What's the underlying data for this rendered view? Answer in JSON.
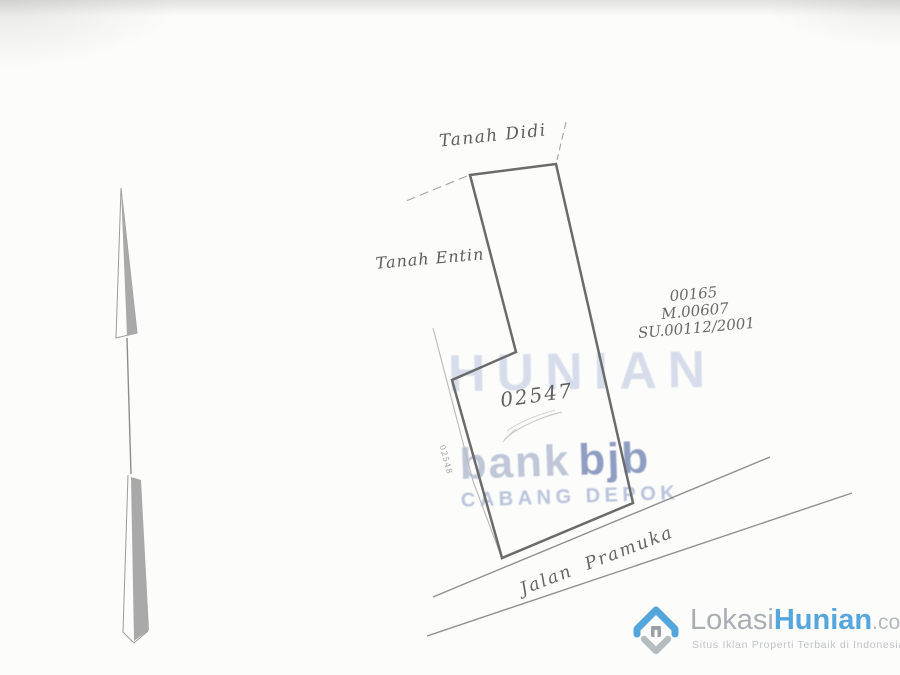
{
  "survey": {
    "labels": {
      "north_neighbor": "Tanah Didi",
      "west_neighbor": "Tanah Entin",
      "road_name": "Jalan Pramuka"
    },
    "parcel_number": "02547",
    "adjacent_parcel_number": "02548",
    "certificate": {
      "line1": "00165",
      "line2": "M.00607",
      "line3": "SU.00112/2001"
    }
  },
  "watermarks": {
    "site_word": "HUNIAN",
    "stamp": {
      "bank": "bank",
      "bjb": "bjb",
      "branch": "CABANG DEPOK"
    }
  },
  "logo": {
    "part1": "Lokasi",
    "part2": "Hunian",
    "tld": ".com",
    "tagline": "Situs Iklan Properti Terbaik di Indonesia"
  },
  "colors": {
    "brand_blue": "#55a6dc",
    "stamp_blue": "#7486b4",
    "ink_gray": "#6b6b6b",
    "paper": "#fcfcfa"
  }
}
